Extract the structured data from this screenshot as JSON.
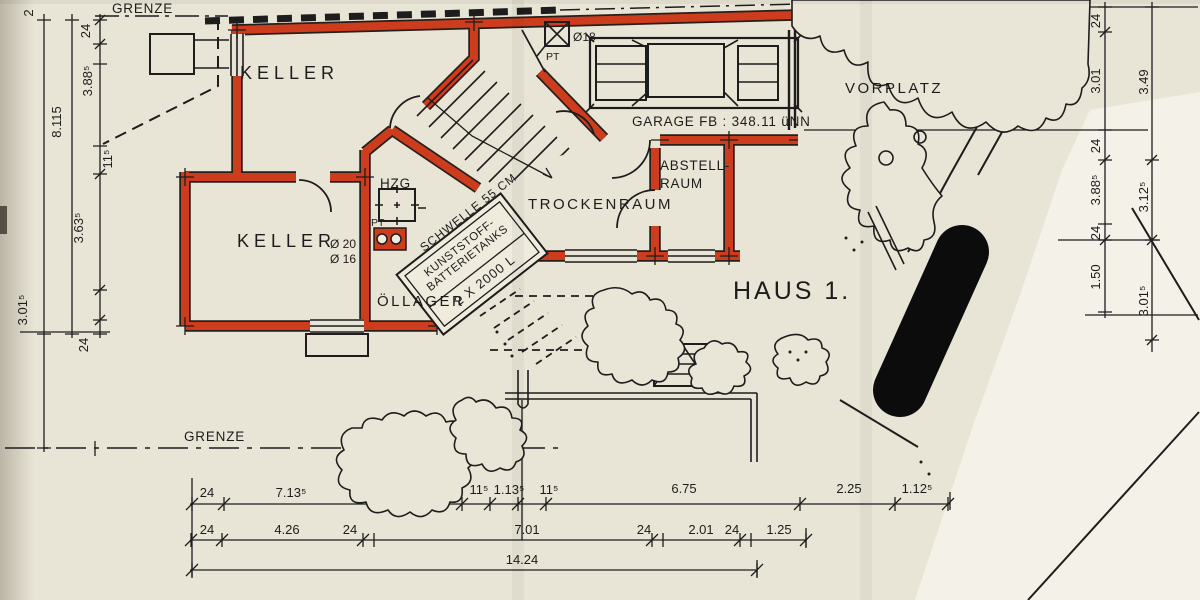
{
  "colors": {
    "paper": "#e9e5d6",
    "paper_bright": "#f7f5ef",
    "wall_red": "#cd3d1d",
    "ink": "#1d1d1d",
    "censor_black": "#0c0c0c"
  },
  "labels": {
    "grenze_top": "GRENZE",
    "grenze_bottom": "GRENZE",
    "keller_upper": "KELLER",
    "keller_lower": "KELLER",
    "hzg": "HZG",
    "pt_hzg": "PT",
    "pt_top": "PT",
    "dia18": "Ø18",
    "dia20": "Ø 20",
    "dia16": "Ø 16",
    "schwelle": "SCHWELLE 55 CM",
    "tank_line1": "KUNSTSTOFF-",
    "tank_line2": "BATTERIETANKS",
    "tank_line3": "2 X 2000 L",
    "oellager": "ÖLLAGER",
    "trockenraum": "TROCKENRAUM",
    "abstell_line1": "ABSTELL-",
    "abstell_line2": "RAUM",
    "garage": "GARAGE FB : 348.11 üNN",
    "vorplatz": "VORPLATZ",
    "haus": "HAUS 1."
  },
  "dims": {
    "left": [
      "2",
      "24",
      "3.88⁵",
      "8.115",
      "11⁵",
      "3.63⁵",
      "24",
      "3.01⁵"
    ],
    "right_inner": [
      "24",
      "3.01",
      "24",
      "3.88⁵",
      "24",
      "1.50"
    ],
    "right_outer": [
      "3.49",
      "3.12⁵",
      "3.01⁵"
    ],
    "bottom_row1": [
      "24",
      "7.13⁵",
      "11⁵",
      "1.13⁵",
      "11⁵",
      "6.75",
      "2.25",
      "1.12⁵"
    ],
    "bottom_row2": [
      "24",
      "4.26",
      "24",
      "7.01",
      "24",
      "2.01",
      "24",
      "1.25"
    ],
    "bottom_total": "14.24"
  }
}
